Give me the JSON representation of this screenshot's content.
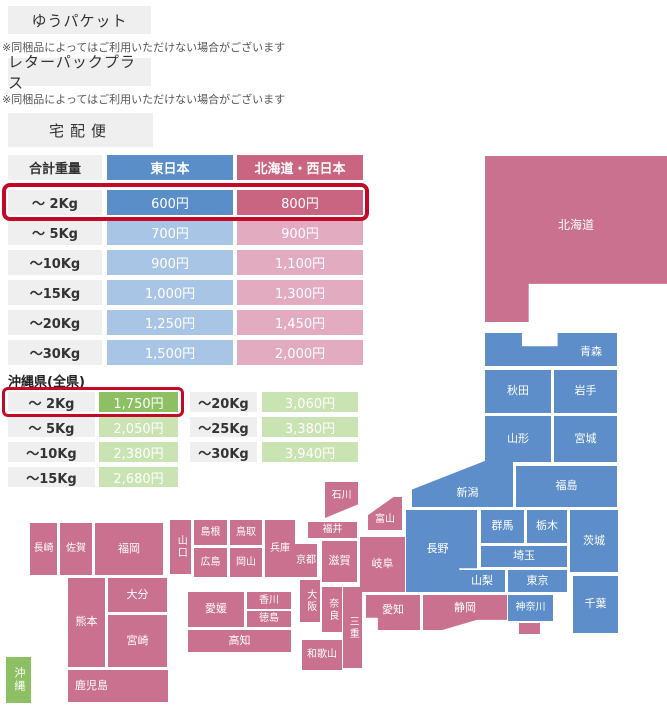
{
  "colors": {
    "orange": "#f3a64e",
    "gray_box": "#efefef",
    "blue_dark": "#5a8ec9",
    "blue_light": "#a9c5e6",
    "pink_dark": "#c96481",
    "pink_light": "#e2abc0",
    "map_blue": "#5d8ec9",
    "map_pink": "#c9718f",
    "green_dark": "#8dc063",
    "green_light": "#c9e3b2",
    "highlight_red": "#c20a26",
    "label_text": "#333333",
    "note_text": "#555555"
  },
  "services": [
    {
      "label": "ゆうパケット",
      "price_prefix": "全国一律",
      "price": "198",
      "price_unit": "円",
      "note": "※同梱品によってはご利用いただけない場合がございます"
    },
    {
      "label": "レターパックプラス",
      "price_prefix": "全国一律",
      "price": "600",
      "price_unit": "円",
      "note": "※同梱品によってはご利用いただけない場合がございます"
    }
  ],
  "takuhaibin": {
    "title": "宅配便",
    "headers": [
      "合計重量",
      "東日本",
      "北海道・西日本"
    ],
    "rows": [
      {
        "weight": "～ 2Kg",
        "east": "600円",
        "west": "800円",
        "highlight": true
      },
      {
        "weight": "～ 5Kg",
        "east": "700円",
        "west": "900円",
        "highlight": false
      },
      {
        "weight": "～10Kg",
        "east": "900円",
        "west": "1,100円",
        "highlight": false
      },
      {
        "weight": "～15Kg",
        "east": "1,000円",
        "west": "1,300円",
        "highlight": false
      },
      {
        "weight": "～20Kg",
        "east": "1,250円",
        "west": "1,450円",
        "highlight": false
      },
      {
        "weight": "～30Kg",
        "east": "1,500円",
        "west": "2,000円",
        "highlight": false
      }
    ]
  },
  "okinawa": {
    "title": "沖縄県(全県)",
    "left_rows": [
      {
        "weight": "～ 2Kg",
        "price": "1,750円",
        "highlight": true
      },
      {
        "weight": "～ 5Kg",
        "price": "2,050円",
        "highlight": false
      },
      {
        "weight": "～10Kg",
        "price": "2,380円",
        "highlight": false
      },
      {
        "weight": "～15Kg",
        "price": "2,680円",
        "highlight": false
      }
    ],
    "right_rows": [
      {
        "weight": "～20Kg",
        "price": "3,060円",
        "highlight": false
      },
      {
        "weight": "～25Kg",
        "price": "3,380円",
        "highlight": false
      },
      {
        "weight": "～30Kg",
        "price": "3,940円",
        "highlight": false
      }
    ]
  },
  "map": {
    "zones": {
      "east": "東日本",
      "west": "北海道・西日本",
      "okinawa": "沖縄"
    },
    "prefectures": [
      {
        "id": "hokkaido",
        "name": "北海道",
        "region": "west",
        "x": 485,
        "y": 156,
        "w": 182,
        "h": 166,
        "clip": "polygon(0 0,100% 0,100% 77%,24% 77%,24% 100%,0 100%)",
        "fs": 12,
        "ty": -13
      },
      {
        "id": "aomori",
        "name": "青森",
        "region": "east",
        "x": 485,
        "y": 333,
        "w": 132,
        "h": 33,
        "clip": "polygon(0 0,28% 0,28% 40%,55% 40%,55% 0,100% 0,100% 100%,0 100%)",
        "tx": 40,
        "ty": 3
      },
      {
        "id": "akita",
        "name": "秋田",
        "region": "east",
        "x": 485,
        "y": 370,
        "w": 66,
        "h": 43
      },
      {
        "id": "iwate",
        "name": "岩手",
        "region": "east",
        "x": 554,
        "y": 370,
        "w": 63,
        "h": 43
      },
      {
        "id": "yamagata",
        "name": "山形",
        "region": "east",
        "x": 485,
        "y": 416,
        "w": 66,
        "h": 46
      },
      {
        "id": "miyagi",
        "name": "宮城",
        "region": "east",
        "x": 554,
        "y": 416,
        "w": 63,
        "h": 46
      },
      {
        "id": "fukushima",
        "name": "福島",
        "region": "east",
        "x": 516,
        "y": 466,
        "w": 101,
        "h": 41
      },
      {
        "id": "niigata",
        "name": "新潟",
        "region": "east",
        "x": 412,
        "y": 461,
        "w": 101,
        "h": 46,
        "clip": "polygon(0 62%,72% 0,100% 0,100% 100%,0 100%)",
        "tx": 5,
        "ty": 9
      },
      {
        "id": "gunma",
        "name": "群馬",
        "region": "east",
        "x": 481,
        "y": 510,
        "w": 43,
        "h": 33
      },
      {
        "id": "tochigi",
        "name": "栃木",
        "region": "east",
        "x": 527,
        "y": 510,
        "w": 40,
        "h": 33
      },
      {
        "id": "ibaraki",
        "name": "茨城",
        "region": "east",
        "x": 570,
        "y": 510,
        "w": 48,
        "h": 62
      },
      {
        "id": "saitama",
        "name": "埼玉",
        "region": "east",
        "x": 481,
        "y": 546,
        "w": 86,
        "h": 21
      },
      {
        "id": "nagano",
        "name": "長野",
        "region": "east",
        "x": 406,
        "y": 510,
        "w": 71,
        "h": 82,
        "clip": "polygon(0 0,100% 0,100% 71%,75% 71%,75% 100%,0 100%)",
        "tx": -4,
        "ty": -2
      },
      {
        "id": "yamanashi",
        "name": "山梨",
        "region": "east",
        "x": 459,
        "y": 570,
        "w": 46,
        "h": 22
      },
      {
        "id": "tokyo",
        "name": "東京",
        "region": "east",
        "x": 508,
        "y": 570,
        "w": 59,
        "h": 22
      },
      {
        "id": "kanagawa",
        "name": "神奈川",
        "region": "east",
        "x": 508,
        "y": 595,
        "w": 45,
        "h": 26,
        "fs": 10
      },
      {
        "id": "chiba",
        "name": "千葉",
        "region": "east",
        "x": 573,
        "y": 576,
        "w": 45,
        "h": 57
      },
      {
        "id": "shizuoka",
        "name": "静岡",
        "region": "west",
        "x": 423,
        "y": 595,
        "w": 84,
        "h": 35,
        "clip": "polygon(0 0,100% 0,100% 71%,64% 71%,23% 100%,0 100%)",
        "ty": -4
      },
      {
        "id": "shizuoka-izu",
        "name": "",
        "region": "west",
        "x": 519,
        "y": 623,
        "w": 21,
        "h": 11
      },
      {
        "id": "aichi",
        "name": "愛知",
        "region": "west",
        "x": 366,
        "y": 595,
        "w": 54,
        "h": 35,
        "ty": -2,
        "clip": "polygon(0 0,100% 0,100% 100%,22% 100%,22% 65%,0 65%)"
      },
      {
        "id": "gifu",
        "name": "岐阜",
        "region": "west",
        "x": 360,
        "y": 537,
        "w": 45,
        "h": 55
      },
      {
        "id": "toyama",
        "name": "富山",
        "region": "west",
        "x": 368,
        "y": 497,
        "w": 34,
        "h": 33,
        "clip": "polygon(0 55%,75% 0,100% 0,100% 100%,0 100%)",
        "ty": 6,
        "fs": 10
      },
      {
        "id": "ishikawa",
        "name": "石川",
        "region": "west",
        "x": 325,
        "y": 482,
        "w": 33,
        "h": 36,
        "clip": "polygon(0 0,100% 0,100% 62%,0 100%)",
        "ty": -4,
        "fs": 10
      },
      {
        "id": "fukui",
        "name": "福井",
        "region": "west",
        "x": 308,
        "y": 522,
        "w": 49,
        "h": 16,
        "fs": 10
      },
      {
        "id": "shiga",
        "name": "滋賀",
        "region": "west",
        "x": 322,
        "y": 541,
        "w": 35,
        "h": 41
      },
      {
        "id": "kyoto",
        "name": "京都",
        "region": "west",
        "x": 295,
        "y": 544,
        "w": 22,
        "h": 33,
        "fs": 10
      },
      {
        "id": "osaka",
        "name": "大阪",
        "region": "west",
        "x": 300,
        "y": 580,
        "w": 20,
        "h": 42,
        "vertical": true,
        "fs": 10
      },
      {
        "id": "nara",
        "name": "奈良",
        "region": "west",
        "x": 322,
        "y": 587,
        "w": 20,
        "h": 45,
        "vertical": true,
        "fs": 10
      },
      {
        "id": "mie",
        "name": "三重",
        "region": "west",
        "x": 343,
        "y": 587,
        "w": 19,
        "h": 81,
        "vertical": true,
        "fs": 10
      },
      {
        "id": "wakayama",
        "name": "和歌山",
        "region": "west",
        "x": 302,
        "y": 640,
        "w": 40,
        "h": 30,
        "fs": 10
      },
      {
        "id": "hyogo",
        "name": "兵庫",
        "region": "west",
        "x": 265,
        "y": 520,
        "w": 30,
        "h": 57,
        "fs": 10
      },
      {
        "id": "tottori",
        "name": "鳥取",
        "region": "west",
        "x": 230,
        "y": 520,
        "w": 32,
        "h": 25,
        "fs": 10
      },
      {
        "id": "shimane",
        "name": "島根",
        "region": "west",
        "x": 194,
        "y": 520,
        "w": 33,
        "h": 25,
        "fs": 10
      },
      {
        "id": "okayama",
        "name": "岡山",
        "region": "west",
        "x": 230,
        "y": 548,
        "w": 32,
        "h": 29,
        "fs": 10
      },
      {
        "id": "hiroshima",
        "name": "広島",
        "region": "west",
        "x": 194,
        "y": 548,
        "w": 33,
        "h": 29,
        "fs": 10
      },
      {
        "id": "yamaguchi",
        "name": "山口",
        "region": "west",
        "x": 170,
        "y": 520,
        "w": 21,
        "h": 54,
        "vertical": true,
        "fs": 10
      },
      {
        "id": "kagawa",
        "name": "香川",
        "region": "west",
        "x": 247,
        "y": 592,
        "w": 44,
        "h": 17,
        "fs": 10
      },
      {
        "id": "tokushima",
        "name": "徳島",
        "region": "west",
        "x": 247,
        "y": 611,
        "w": 44,
        "h": 16,
        "fs": 10
      },
      {
        "id": "ehime",
        "name": "愛媛",
        "region": "west",
        "x": 188,
        "y": 592,
        "w": 56,
        "h": 35
      },
      {
        "id": "kochi",
        "name": "高知",
        "region": "west",
        "x": 188,
        "y": 630,
        "w": 103,
        "h": 22
      },
      {
        "id": "fukuoka",
        "name": "福岡",
        "region": "west",
        "x": 95,
        "y": 523,
        "w": 68,
        "h": 52
      },
      {
        "id": "saga",
        "name": "佐賀",
        "region": "west",
        "x": 60,
        "y": 523,
        "w": 32,
        "h": 52,
        "fs": 10
      },
      {
        "id": "nagasaki",
        "name": "長崎",
        "region": "west",
        "x": 30,
        "y": 523,
        "w": 27,
        "h": 52,
        "fs": 10
      },
      {
        "id": "oita",
        "name": "大分",
        "region": "west",
        "x": 108,
        "y": 578,
        "w": 59,
        "h": 34
      },
      {
        "id": "kumamoto",
        "name": "熊本",
        "region": "west",
        "x": 68,
        "y": 578,
        "w": 37,
        "h": 89
      },
      {
        "id": "miyazaki",
        "name": "宮崎",
        "region": "west",
        "x": 108,
        "y": 615,
        "w": 59,
        "h": 52
      },
      {
        "id": "kagoshima",
        "name": "鹿児島",
        "region": "west",
        "x": 68,
        "y": 670,
        "w": 100,
        "h": 32,
        "alignLeft": true
      },
      {
        "id": "okinawa",
        "name": "沖縄",
        "region": "okinawa",
        "x": 6,
        "y": 657,
        "w": 25,
        "h": 46,
        "vertical": true,
        "fs": 11
      }
    ]
  }
}
